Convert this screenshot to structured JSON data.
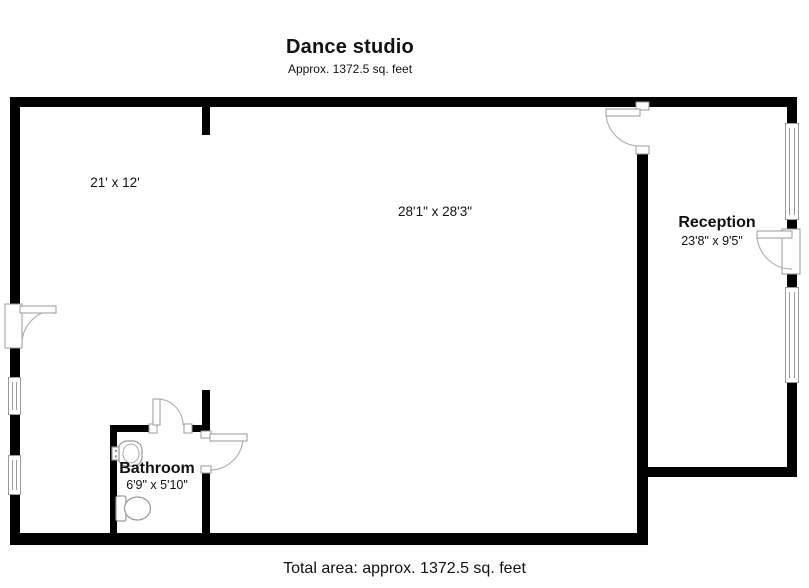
{
  "header": {
    "title": "Dance studio",
    "subtitle": "Approx. 1372.5 sq. feet"
  },
  "rooms": {
    "area_21x12": {
      "dimensions": "21' x 12'"
    },
    "studio": {
      "dimensions": "28'1\" x 28'3\""
    },
    "reception": {
      "name": "Reception",
      "dimensions": "23'8\" x 9'5\""
    },
    "bathroom": {
      "name": "Bathroom",
      "dimensions": "6'9\" x 5'10\""
    }
  },
  "footer": {
    "total_area": "Total area: approx. 1372.5 sq. feet"
  },
  "fixtures": [
    "sink-icon",
    "toilet-icon"
  ],
  "colors": {
    "wall": "#000000",
    "fixture_line": "#9a9a9a",
    "text": "#111111",
    "background": "#ffffff"
  }
}
